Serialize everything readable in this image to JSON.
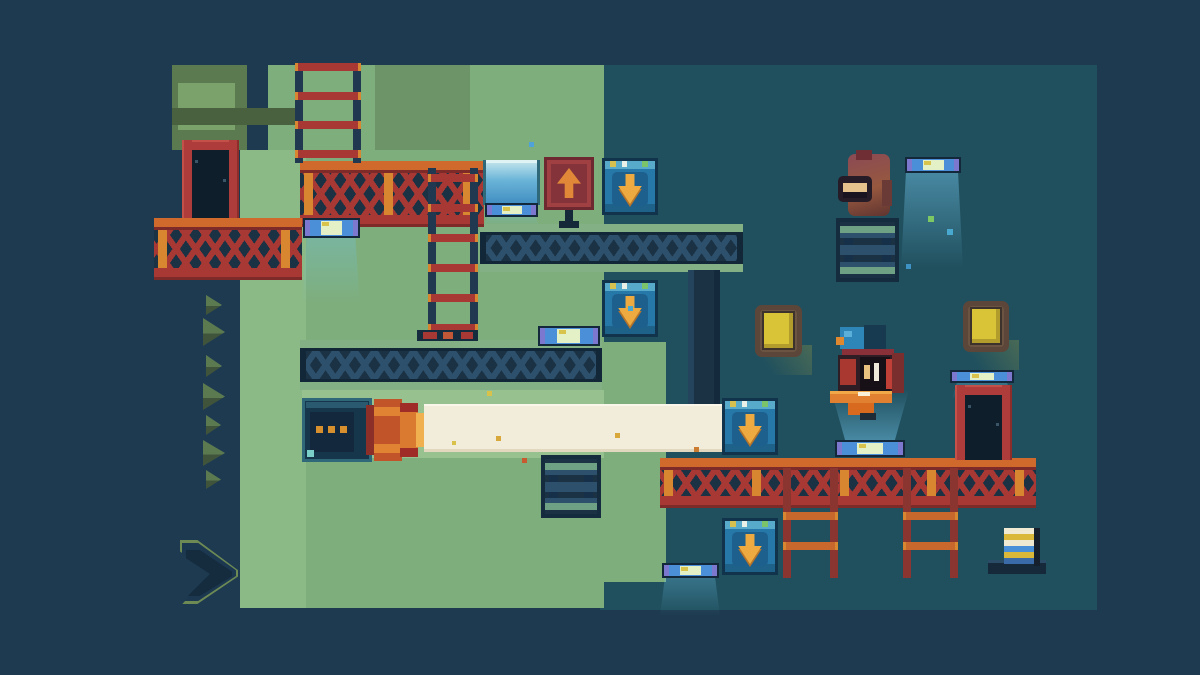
{
  "scene": {
    "width": 1200,
    "height": 675
  },
  "palette": {
    "bg_outer": "#1d3a50",
    "bg_room": "#20505e",
    "green_main": "#7eae7c",
    "green_light": "#8bba86",
    "green_med": "#6d9468",
    "green_lit": "#97c18e",
    "olive": "#5c7a50",
    "olive_dark": "#49613f",
    "olive_inner": "#7ca26c",
    "navy": "#1b3245",
    "navy_dark": "#122838",
    "steel": "#2d516d",
    "beam_edge": "#83b185",
    "truss_red": "#a83833",
    "truss_orange": "#cf6a2c",
    "truss_orange_light": "#d8862f",
    "truss_red_dark": "#7e2a28",
    "block_border": "#11334b",
    "block_body": "#2678a8",
    "block_panel": "#1d608e",
    "block_top": "#58aacb",
    "arrow_orange": "#ecaa40",
    "arrow_shadow": "#b5742a",
    "sign_red": "#a04043",
    "sign_inner": "#84333a",
    "sign_frame": "#6e2830",
    "sign_arrow": "#e08838",
    "lamp_frame": "#13293b",
    "lamp_blue": "#4a8fd8",
    "lamp_pale": "#e4f0c6",
    "lamp_purple": "#7d78cf",
    "lamp_yellow": "#d8c44c",
    "glow": "rgba(110,195,235,0.30)",
    "glow_strong": "rgba(120,205,245,0.45)",
    "beam_cream": "#f2ecdb",
    "door_red": "#ad3c3a",
    "door_dark": "#0f1e2b",
    "bulb_frame": "#5c4639",
    "bulb_mid": "#6b5542",
    "bulb_core": "#d9c437",
    "rail_red": "#8a3530",
    "rung_orange": "#c9682c",
    "rail_navy": "#203850"
  },
  "regions": [
    {
      "name": "room-interior",
      "x": 600,
      "y": 65,
      "w": 497,
      "h": 545,
      "color": "bg_room"
    },
    {
      "name": "green-wall-top",
      "x": 268,
      "y": 65,
      "w": 336,
      "h": 95,
      "color": "green_main"
    },
    {
      "name": "green-wall-top-shaded",
      "x": 375,
      "y": 65,
      "w": 95,
      "h": 93,
      "color": "green_med"
    },
    {
      "name": "green-wall-main",
      "x": 240,
      "y": 150,
      "w": 364,
      "h": 458,
      "color": "green_main"
    },
    {
      "name": "green-wall-left-light",
      "x": 240,
      "y": 150,
      "w": 66,
      "h": 458,
      "color": "green_light"
    },
    {
      "name": "green-wall-right-ext",
      "x": 604,
      "y": 342,
      "w": 62,
      "h": 240,
      "color": "green_main"
    },
    {
      "name": "green-wall-lit-by-beam",
      "x": 302,
      "y": 390,
      "w": 302,
      "h": 68,
      "color": "green_lit"
    },
    {
      "name": "olive-column",
      "x": 172,
      "y": 65,
      "w": 75,
      "h": 85,
      "color": "olive"
    },
    {
      "name": "olive-column-face",
      "x": 178,
      "y": 83,
      "w": 57,
      "h": 47,
      "color": "olive_inner"
    },
    {
      "name": "olive-band",
      "x": 172,
      "y": 108,
      "w": 130,
      "h": 17,
      "color": "olive_dark"
    }
  ],
  "glows": [
    {
      "name": "glow-under-window",
      "x": 484,
      "y": 214,
      "w": 55,
      "h": 12,
      "dir": "down",
      "strong": false
    },
    {
      "name": "glow-lamp-left",
      "x": 302,
      "y": 238,
      "w": 58,
      "h": 66,
      "dir": "down",
      "strong": false
    },
    {
      "name": "glow-lamp-mid",
      "x": 537,
      "y": 346,
      "w": 64,
      "h": 44,
      "dir": "down",
      "strong": false
    },
    {
      "name": "glow-lamp-topright",
      "x": 901,
      "y": 172,
      "w": 62,
      "h": 96,
      "dir": "down",
      "strong": true
    },
    {
      "name": "glow-lamp-under-character",
      "x": 831,
      "y": 390,
      "w": 78,
      "h": 50,
      "dir": "up",
      "strong": true
    },
    {
      "name": "glow-lamp-bottom-edge",
      "x": 660,
      "y": 578,
      "w": 60,
      "h": 38,
      "dir": "down",
      "strong": false
    },
    {
      "name": "glow-lamp-right-door",
      "x": 952,
      "y": 383,
      "w": 60,
      "h": 16,
      "dir": "down",
      "strong": false
    }
  ],
  "beams": [
    {
      "name": "ibeam-upper",
      "x": 480,
      "y": 224,
      "w": 263,
      "h": 48
    },
    {
      "name": "ibeam-lower",
      "x": 300,
      "y": 340,
      "w": 302,
      "h": 50
    }
  ],
  "pillars": [
    {
      "name": "support-pillar",
      "x": 688,
      "y": 270,
      "w": 32,
      "h": 134
    }
  ],
  "red_platforms": [
    {
      "name": "truss-platform-top",
      "x": 300,
      "y": 161,
      "w": 184,
      "h": 66
    },
    {
      "name": "truss-platform-left",
      "x": 154,
      "y": 218,
      "w": 148,
      "h": 62
    },
    {
      "name": "truss-platform-bottom",
      "x": 660,
      "y": 458,
      "w": 376,
      "h": 50
    }
  ],
  "ladders": [
    {
      "name": "ladder-tower-top",
      "x": 295,
      "y": 63,
      "w": 66,
      "h": 100,
      "rail": "rail_navy",
      "rung": "truss_red",
      "first": 0,
      "gap": 29
    },
    {
      "name": "ladder-middle",
      "x": 428,
      "y": 168,
      "w": 50,
      "h": 168,
      "rail": "rail_navy",
      "rung": "truss_red",
      "first": 6,
      "gap": 30
    },
    {
      "name": "ladder-hanging-left",
      "x": 783,
      "y": 468,
      "w": 55,
      "h": 110,
      "rail": "rail_red",
      "rung": "rung_orange",
      "first": 44,
      "gap": 30
    },
    {
      "name": "ladder-hanging-right",
      "x": 903,
      "y": 468,
      "w": 55,
      "h": 110,
      "rail": "rail_red",
      "rung": "rung_orange",
      "first": 44,
      "gap": 30
    }
  ],
  "pedestals": [
    {
      "name": "pedestal-under-monkey",
      "x": 836,
      "y": 218,
      "w": 63,
      "h": 64
    },
    {
      "name": "pedestal-mid-bottom",
      "x": 541,
      "y": 455,
      "w": 60,
      "h": 63
    }
  ],
  "window": {
    "name": "light-window",
    "x": 483,
    "y": 160,
    "w": 57,
    "h": 45
  },
  "lamps": [
    {
      "name": "lamp-under-window",
      "x": 485,
      "y": 203,
      "w": 53,
      "h": 14
    },
    {
      "name": "lamp-left",
      "x": 303,
      "y": 218,
      "w": 57,
      "h": 20
    },
    {
      "name": "lamp-mid",
      "x": 538,
      "y": 326,
      "w": 62,
      "h": 20
    },
    {
      "name": "lamp-top-right",
      "x": 905,
      "y": 157,
      "w": 56,
      "h": 16
    },
    {
      "name": "lamp-above-right-door",
      "x": 950,
      "y": 370,
      "w": 64,
      "h": 13
    },
    {
      "name": "lamp-under-character",
      "x": 835,
      "y": 440,
      "w": 70,
      "h": 17
    },
    {
      "name": "lamp-bottom-edge",
      "x": 662,
      "y": 563,
      "w": 57,
      "h": 15
    }
  ],
  "sign": {
    "name": "sign-up-arrow",
    "direction": "up",
    "x": 544,
    "y": 157,
    "w": 50,
    "h": 53
  },
  "arrow_blocks": [
    {
      "name": "arrow-block-down-1",
      "direction": "down",
      "x": 602,
      "y": 158,
      "w": 56,
      "h": 57
    },
    {
      "name": "arrow-block-down-2",
      "direction": "down",
      "x": 602,
      "y": 280,
      "w": 56,
      "h": 57
    },
    {
      "name": "arrow-block-down-3",
      "direction": "down",
      "x": 722,
      "y": 398,
      "w": 56,
      "h": 57
    },
    {
      "name": "arrow-block-down-4",
      "direction": "down",
      "x": 722,
      "y": 518,
      "w": 56,
      "h": 57
    }
  ],
  "laser": {
    "machine": {
      "name": "laser-machine",
      "x": 302,
      "y": 398,
      "w": 70,
      "h": 64
    },
    "emitter": {
      "name": "laser-emitter",
      "x": 366,
      "y": 399,
      "w": 58,
      "h": 62
    },
    "beam": {
      "name": "laser-beam",
      "x": 424,
      "y": 404,
      "w": 298,
      "h": 48
    }
  },
  "doors": [
    {
      "name": "door-left",
      "x": 182,
      "y": 140,
      "w": 57,
      "h": 78
    },
    {
      "name": "door-right",
      "x": 955,
      "y": 385,
      "w": 57,
      "h": 75
    }
  ],
  "bulbs": [
    {
      "name": "yellow-wall-light-left",
      "x": 755,
      "y": 305,
      "w": 47,
      "h": 52
    },
    {
      "name": "yellow-wall-light-right",
      "x": 963,
      "y": 301,
      "w": 46,
      "h": 51
    }
  ],
  "vent": {
    "name": "vent-strip",
    "x": 417,
    "y": 330,
    "w": 61,
    "h": 11
  },
  "item": {
    "name": "collectible-striped-stack",
    "x": 1004,
    "y": 528,
    "w": 36,
    "h": 38,
    "stripes": [
      "#f0ead2",
      "#d9b83a",
      "#f0ead2",
      "#4a90d9",
      "#d9b83a",
      "#3a6aa8"
    ],
    "ledge": {
      "x": 988,
      "y": 560,
      "w": 58,
      "h": 14
    }
  },
  "character": {
    "name": "player-character",
    "x": 830,
    "y": 325,
    "w": 75,
    "h": 95
  },
  "monkey": {
    "name": "monkey-creature",
    "x": 838,
    "y": 150,
    "w": 58,
    "h": 68
  },
  "chevron": {
    "name": "big-chevron-marker",
    "x": 180,
    "y": 540,
    "w": 58,
    "h": 64
  },
  "mini_chevrons": [
    {
      "x": 206,
      "y": 295,
      "w": 16,
      "h": 20
    },
    {
      "x": 203,
      "y": 318,
      "w": 22,
      "h": 28
    },
    {
      "x": 206,
      "y": 355,
      "w": 16,
      "h": 22
    },
    {
      "x": 203,
      "y": 383,
      "w": 22,
      "h": 27
    },
    {
      "x": 206,
      "y": 415,
      "w": 15,
      "h": 20
    },
    {
      "x": 203,
      "y": 440,
      "w": 22,
      "h": 26
    },
    {
      "x": 206,
      "y": 470,
      "w": 15,
      "h": 19
    }
  ],
  "particles": [
    {
      "x": 529,
      "y": 142,
      "s": 5,
      "color": "#4fa3d8"
    },
    {
      "x": 928,
      "y": 216,
      "s": 6,
      "color": "#7ec863"
    },
    {
      "x": 947,
      "y": 229,
      "s": 6,
      "color": "#49a8d0"
    },
    {
      "x": 906,
      "y": 264,
      "s": 5,
      "color": "#3f93c4"
    },
    {
      "x": 628,
      "y": 306,
      "s": 5,
      "color": "#49a8d0"
    },
    {
      "x": 487,
      "y": 391,
      "s": 5,
      "color": "#d8c24a"
    },
    {
      "x": 496,
      "y": 436,
      "s": 5,
      "color": "#d8a83a"
    },
    {
      "x": 615,
      "y": 433,
      "s": 5,
      "color": "#d8a83a"
    },
    {
      "x": 694,
      "y": 447,
      "s": 5,
      "color": "#cc7c30"
    },
    {
      "x": 522,
      "y": 458,
      "s": 5,
      "color": "#c85a30"
    },
    {
      "x": 452,
      "y": 441,
      "s": 4,
      "color": "#d8c24a"
    }
  ]
}
